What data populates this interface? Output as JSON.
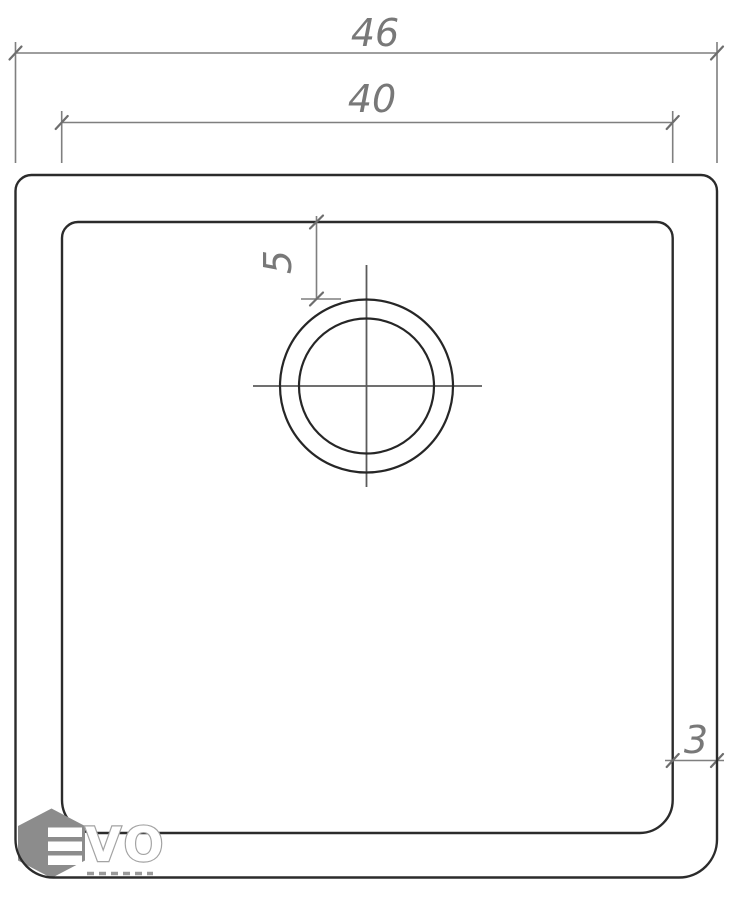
{
  "dimensions": {
    "overall_width": "46",
    "inner_width": "40",
    "drain_offset_from_top": "5",
    "rim_thickness": "3"
  },
  "logo": {
    "brand": "EVO",
    "outline_letters": "VO"
  },
  "colors": {
    "background": "#ffffff",
    "sink_outline": "#2b2b2b",
    "dimension_lines": "#7f7f7f",
    "dimension_text": "#787878",
    "logo_hexagon": "#8c8c8c",
    "logo_letter_outline": "#a3a3a3"
  }
}
